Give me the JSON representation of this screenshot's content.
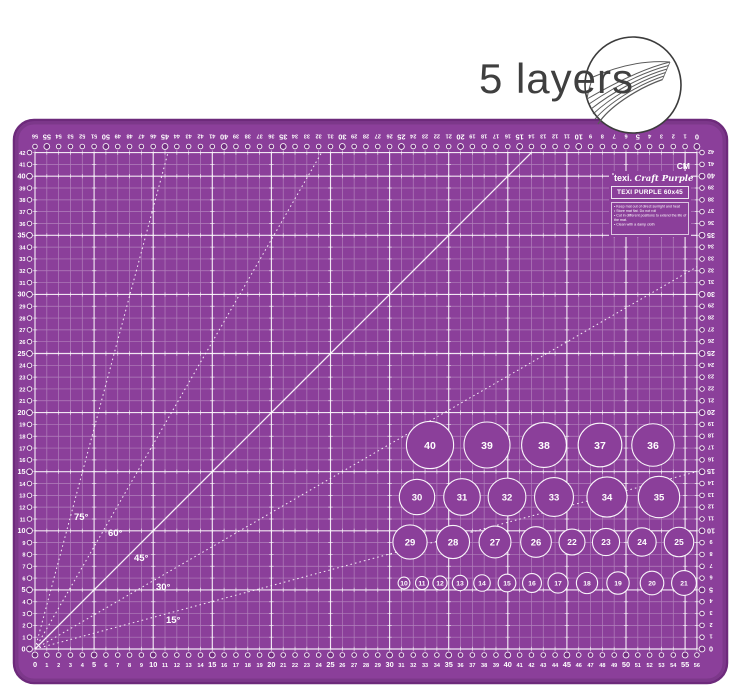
{
  "page": {
    "background": "#ffffff"
  },
  "badge": {
    "label": "5 layers",
    "icon": "layered-sheets-icon",
    "circle_color": "#3c3c3c",
    "text_color": "#3f3f3f"
  },
  "mat": {
    "color": "#8b3f9a",
    "edge_color": "#6d2a7b",
    "grid_minor_color": "rgba(255,255,255,0.34)",
    "grid_major_color": "rgba(255,255,255,0.88)",
    "number_color": "#ffffff",
    "hole_fill_color": "#702c7e",
    "unit_label": "CM",
    "rulers": {
      "unit": "cm",
      "bottom": {
        "start": 0,
        "end": 56,
        "step": 1,
        "bold_every": 5,
        "direction": "left-to-right"
      },
      "top": {
        "start": 56,
        "end": 0,
        "step": 1,
        "bold_every": 5,
        "direction": "left-to-right",
        "rotated_180": true
      },
      "left": {
        "start": 42,
        "end": 0,
        "step": 1,
        "bold_every": 5,
        "direction": "top-to-bottom"
      },
      "right": {
        "start": 42,
        "end": 0,
        "step": 1,
        "bold_every": 5,
        "direction": "top-to-bottom",
        "rotated_180": true
      }
    },
    "angle_lines": [
      {
        "label": "75°",
        "degrees": 75,
        "style": "dotted",
        "label_pos": [
          74,
          520
        ]
      },
      {
        "label": "60°",
        "degrees": 60,
        "style": "dotted",
        "label_pos": [
          108,
          536
        ]
      },
      {
        "label": "45°",
        "degrees": 45,
        "style": "solid",
        "label_pos": [
          134,
          561
        ]
      },
      {
        "label": "30°",
        "degrees": 30,
        "style": "dotted",
        "label_pos": [
          156,
          590
        ]
      },
      {
        "label": "15°",
        "degrees": 15,
        "style": "dotted",
        "label_pos": [
          166,
          623
        ]
      }
    ],
    "circles": [
      {
        "n": 40,
        "x": 430,
        "y": 445
      },
      {
        "n": 39,
        "x": 487,
        "y": 445
      },
      {
        "n": 38,
        "x": 544,
        "y": 445
      },
      {
        "n": 37,
        "x": 600,
        "y": 445
      },
      {
        "n": 36,
        "x": 653,
        "y": 445
      },
      {
        "n": 30,
        "x": 417,
        "y": 497
      },
      {
        "n": 31,
        "x": 462,
        "y": 497
      },
      {
        "n": 32,
        "x": 507,
        "y": 497
      },
      {
        "n": 33,
        "x": 554,
        "y": 497
      },
      {
        "n": 34,
        "x": 607,
        "y": 497
      },
      {
        "n": 35,
        "x": 659,
        "y": 497
      },
      {
        "n": 29,
        "x": 410,
        "y": 542
      },
      {
        "n": 28,
        "x": 453,
        "y": 542
      },
      {
        "n": 27,
        "x": 495,
        "y": 542
      },
      {
        "n": 26,
        "x": 536,
        "y": 542
      },
      {
        "n": 22,
        "x": 572,
        "y": 542
      },
      {
        "n": 23,
        "x": 606,
        "y": 542
      },
      {
        "n": 24,
        "x": 642,
        "y": 542
      },
      {
        "n": 25,
        "x": 679,
        "y": 542
      },
      {
        "n": 10,
        "x": 404,
        "y": 583
      },
      {
        "n": 11,
        "x": 422,
        "y": 583
      },
      {
        "n": 12,
        "x": 440,
        "y": 583
      },
      {
        "n": 13,
        "x": 460,
        "y": 583
      },
      {
        "n": 14,
        "x": 482,
        "y": 583
      },
      {
        "n": 15,
        "x": 507,
        "y": 583
      },
      {
        "n": 16,
        "x": 532,
        "y": 583
      },
      {
        "n": 17,
        "x": 558,
        "y": 583
      },
      {
        "n": 18,
        "x": 587,
        "y": 583
      },
      {
        "n": 19,
        "x": 618,
        "y": 583
      },
      {
        "n": 20,
        "x": 652,
        "y": 583
      },
      {
        "n": 21,
        "x": 684,
        "y": 583
      }
    ]
  },
  "branding": {
    "logo_mark": "*",
    "logo_prefix": "texi.",
    "logo_name": "Craft Purple",
    "model": "TEXI PURPLE 60x45",
    "care_instructions": [
      "Keep mat out of direct sunlight and heat",
      "Store mat flat. Do not roll",
      "Cut in different positions to extend the life of the mat.",
      "Clean with a damp cloth"
    ]
  }
}
